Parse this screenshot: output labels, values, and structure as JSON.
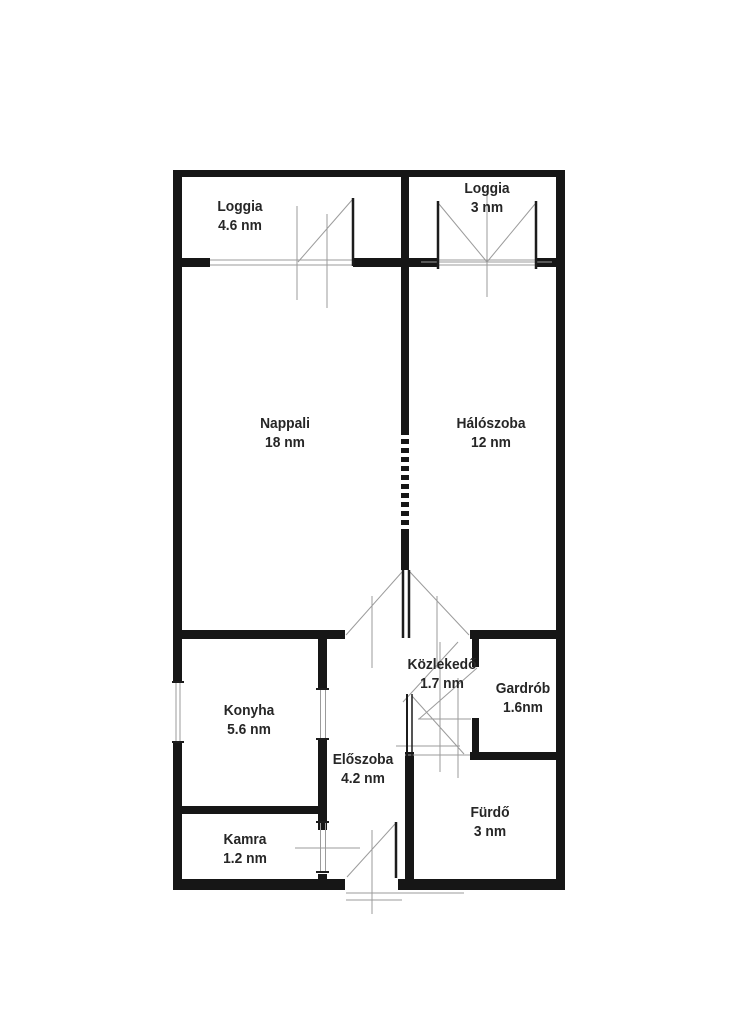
{
  "plan": {
    "title": "apartment-floor-plan",
    "unit": "nm",
    "colors": {
      "wall": "#161616",
      "symbol_line": "#9b9b9b",
      "label_text": "#262626",
      "background": "#ffffff"
    },
    "rooms": [
      {
        "id": "loggia-left",
        "name": "Loggia",
        "area": "4.6 nm"
      },
      {
        "id": "loggia-right",
        "name": "Loggia",
        "area": "3 nm"
      },
      {
        "id": "nappali",
        "name": "Nappali",
        "area": "18 nm"
      },
      {
        "id": "haloszoba",
        "name": "Hálószoba",
        "area": "12 nm"
      },
      {
        "id": "kozlekedo",
        "name": "Közlekedő",
        "area": "1.7 nm"
      },
      {
        "id": "gardrob",
        "name": "Gardrób",
        "area": "1.6nm"
      },
      {
        "id": "konyha",
        "name": "Konyha",
        "area": "5.6 nm"
      },
      {
        "id": "eloszoba",
        "name": "Előszoba",
        "area": "4.2 nm"
      },
      {
        "id": "kamra",
        "name": "Kamra",
        "area": "1.2 nm"
      },
      {
        "id": "furdo",
        "name": "Fürdő",
        "area": "3 nm"
      }
    ]
  }
}
